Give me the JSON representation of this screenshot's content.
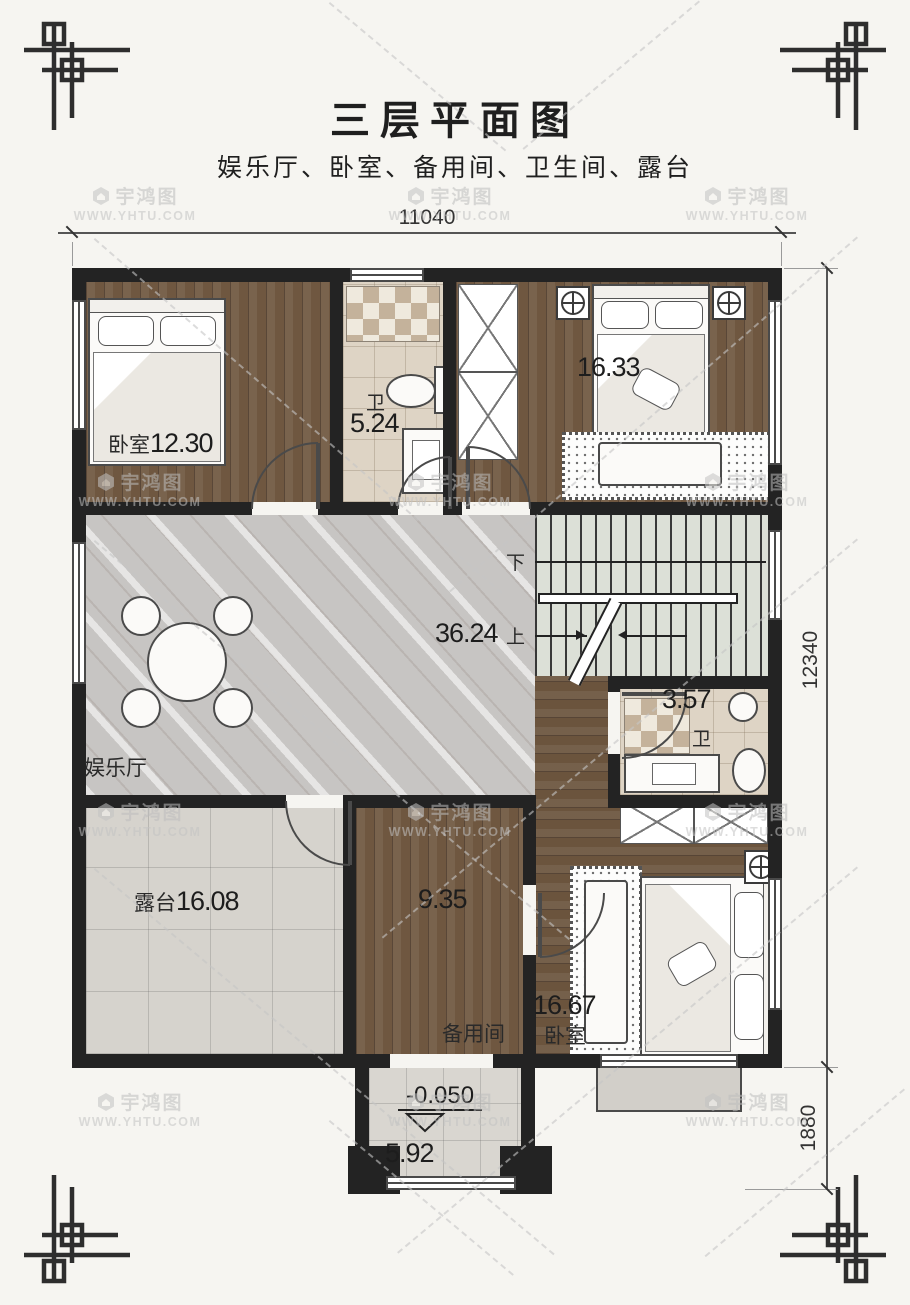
{
  "title": "三层平面图",
  "subtitle": "娱乐厅、卧室、备用间、卫生间、露台",
  "watermark": {
    "brand": "宇鸿图",
    "url": "WWW.YHTU.COM"
  },
  "dimensions": {
    "width_total": "11040",
    "height_main": "12340",
    "height_porch": "1880"
  },
  "elevation_mark": "-0.050",
  "stairs": {
    "down_label": "下",
    "up_label": "上"
  },
  "rooms": {
    "bedroom_top_left": {
      "name": "卧室",
      "area": "12.30"
    },
    "bathroom_top": {
      "name": "卫",
      "area": "5.24"
    },
    "bedroom_top_right": {
      "area": "16.33"
    },
    "entertainment_hall": {
      "name": "娱乐厅",
      "area": "36.24"
    },
    "bathroom_mid": {
      "name": "卫",
      "area": "3.57"
    },
    "terrace": {
      "name": "露台",
      "area": "16.08"
    },
    "spare_room": {
      "name": "备用间",
      "area": "9.35"
    },
    "bedroom_bottom_right": {
      "name": "卧室",
      "area": "16.67"
    },
    "entry_porch": {
      "area": "5.92"
    }
  },
  "colors": {
    "wall": "#232323",
    "wood_floor": "#6f5740",
    "marble_floor": "#c7c5c3",
    "bath_tile": "#ded4c5",
    "terrace_tile": "#d6d3cd",
    "paper": "#f6f5f1"
  }
}
